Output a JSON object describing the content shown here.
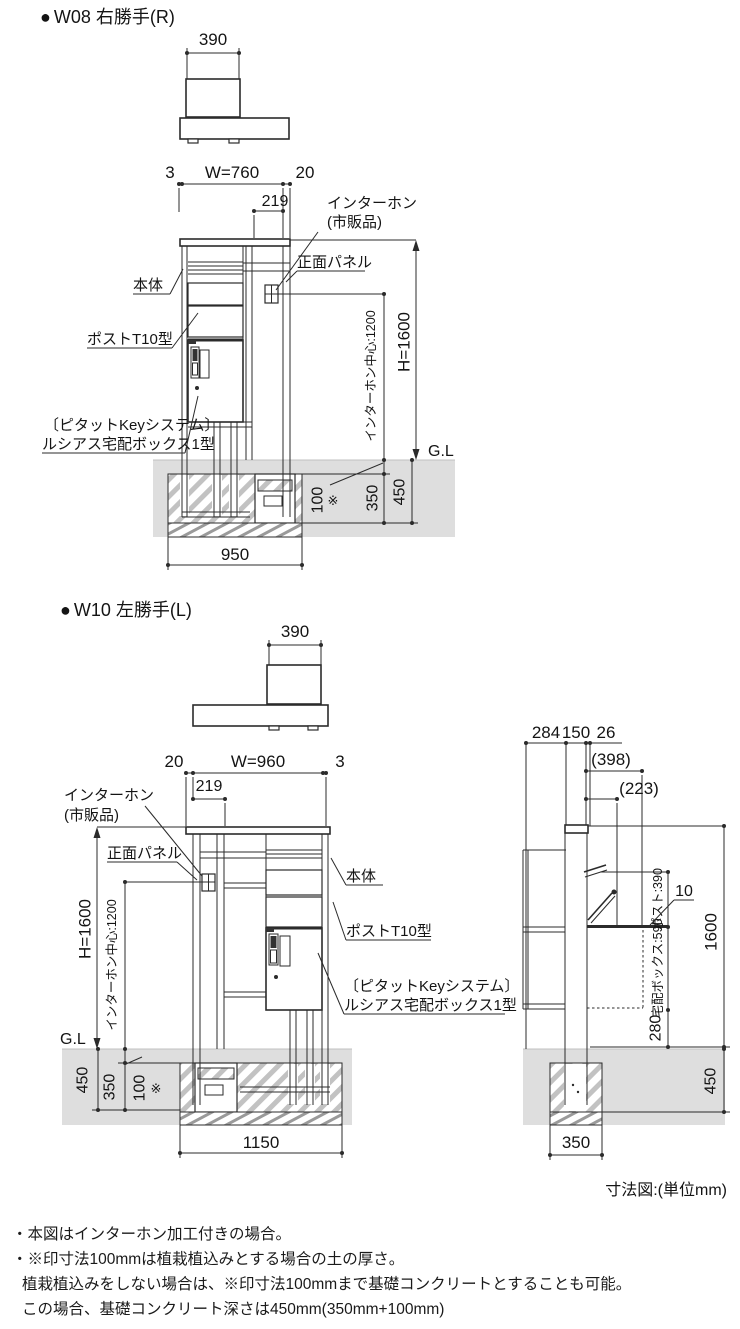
{
  "colors": {
    "line": "#2b2b2b",
    "ground_fill": "#dedede",
    "hatch_gray": "#c2c2c2"
  },
  "bullet": "●",
  "shared_labels": {
    "body": "本体",
    "intercom_line1": "インターホン",
    "intercom_line2": "(市販品)",
    "front_panel": "正面パネル",
    "post_model": "ポストT10型",
    "key_system_line1": "〔ピタットKeyシステム〕",
    "key_system_line2": "ルシアス宅配ボックス1型",
    "ground_level": "G.L",
    "height": "H=1600",
    "intercom_center": "インターホン中心:1200",
    "intercom_offset": "219",
    "top_width": "390",
    "soil_depth": "100",
    "soil_note_mark": "※",
    "foundation_depth": "350",
    "total_depth": "450"
  },
  "w08": {
    "title": "W08 右勝手(R)",
    "dims": {
      "left_gap": "3",
      "width": "W=760",
      "right_gap": "20",
      "foundation_width": "950"
    }
  },
  "w10": {
    "title": "W10 左勝手(L)",
    "dims": {
      "left_gap": "20",
      "width": "W=960",
      "right_gap": "3",
      "foundation_width": "1150"
    }
  },
  "side_view": {
    "dims": {
      "front_depth": "284",
      "post_depth": "150",
      "back_gap": "26",
      "upper_depth_ref": "(398)",
      "box_depth_ref": "(223)",
      "post_height": "ポスト:390",
      "box_height": "宅配ボックス:590",
      "box_bottom_height": "280",
      "plate_thickness": "10",
      "total_height": "1600",
      "foundation_width": "350",
      "foundation_depth": "450"
    }
  },
  "caption": "寸法図:(単位mm)",
  "notes": [
    "・本図はインターホン加工付きの場合。",
    "・※印寸法100mmは植栽植込みとする場合の土の厚さ。",
    "植栽植込みをしない場合は、※印寸法100mmまで基礎コンクリートとすることも可能。",
    "この場合、基礎コンクリート深さは450mm(350mm+100mm)"
  ]
}
